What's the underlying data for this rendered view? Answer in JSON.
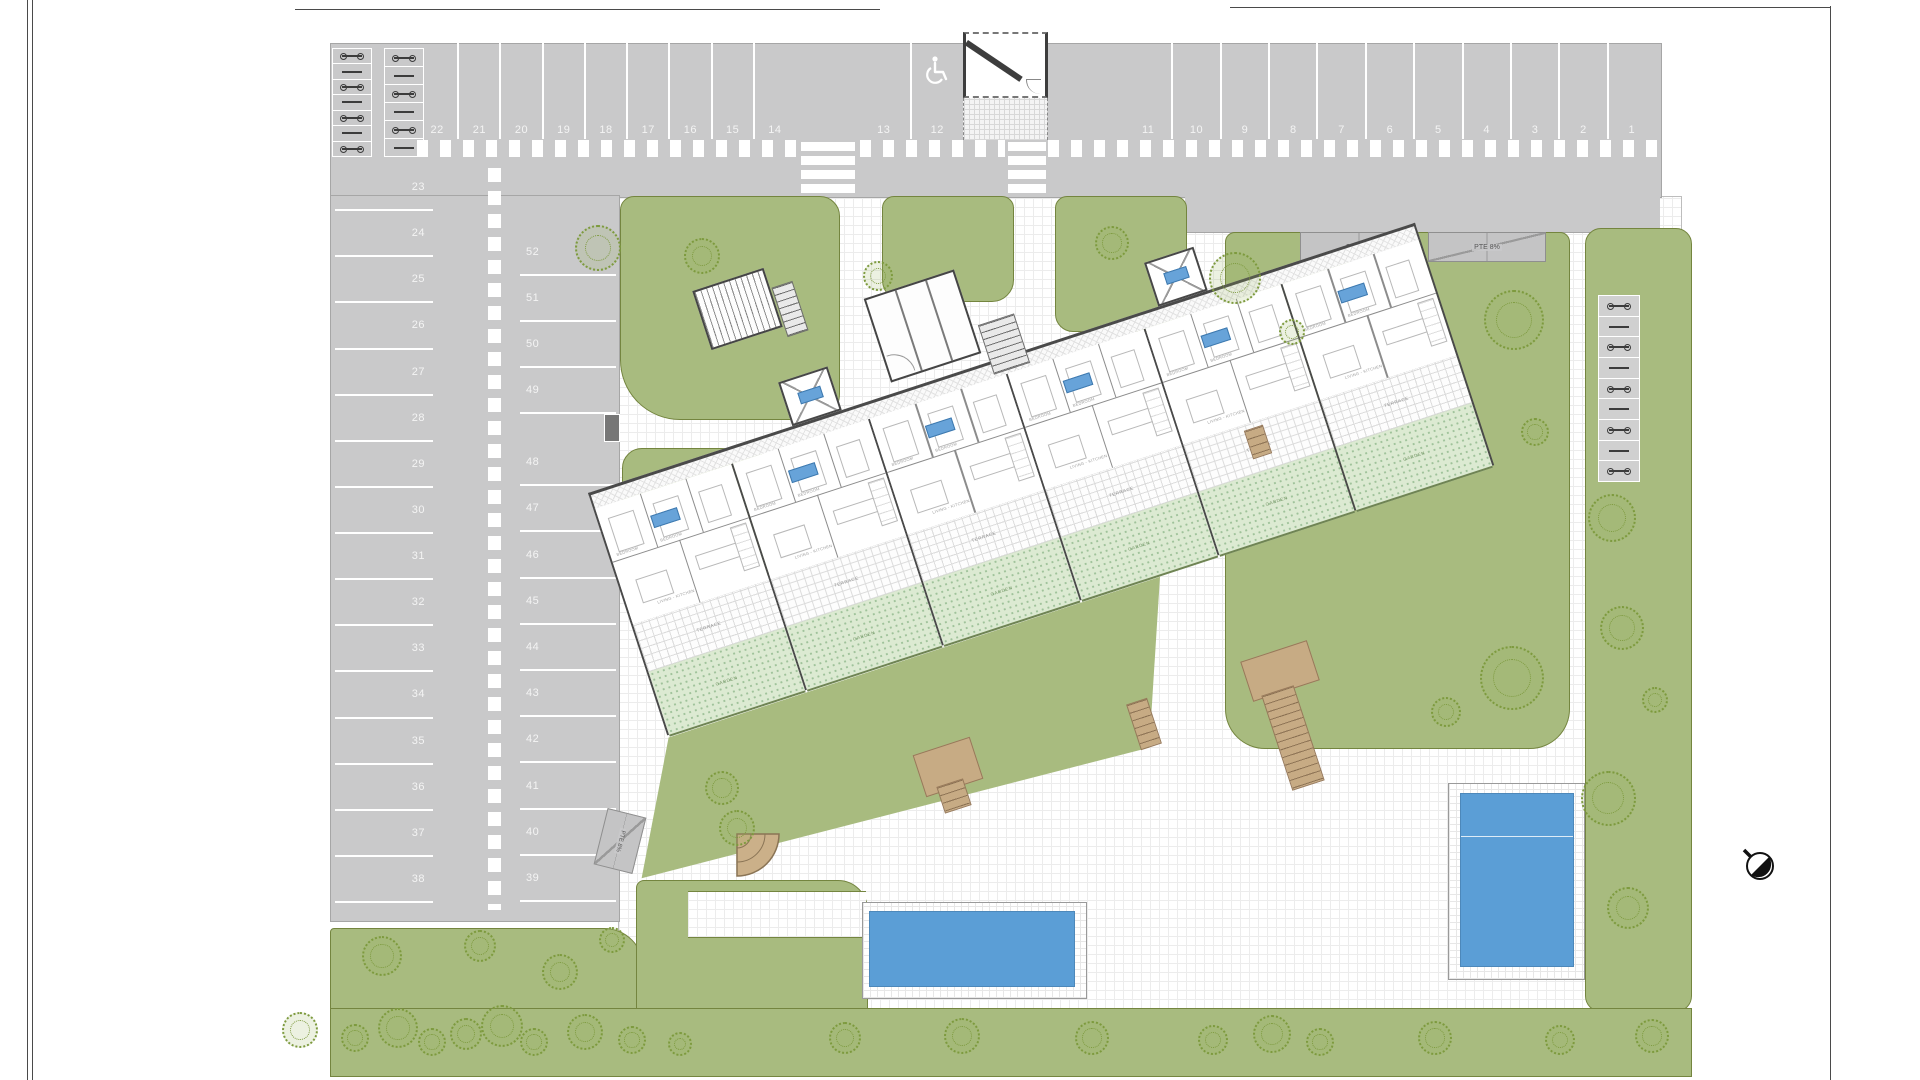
{
  "parking": {
    "top_row_left": [
      "22",
      "21",
      "20",
      "19",
      "18",
      "17",
      "16",
      "15",
      "14"
    ],
    "top_row_mid": [
      "13",
      "12"
    ],
    "accessible_space": "12",
    "top_row_right": [
      "11",
      "10",
      "9",
      "8",
      "7",
      "6",
      "5",
      "4",
      "3",
      "2",
      "1"
    ],
    "left_column": [
      "23",
      "24",
      "25",
      "26",
      "27",
      "28",
      "29",
      "30",
      "31",
      "32",
      "33",
      "34",
      "35",
      "36",
      "37",
      "38"
    ],
    "middle_column_upper": [
      "52",
      "51",
      "50",
      "49"
    ],
    "middle_column_lower": [
      "48",
      "47",
      "46",
      "45",
      "44",
      "43",
      "42",
      "41",
      "40",
      "39"
    ]
  },
  "ramps": {
    "ramp1": "PTE 8%",
    "ramp2": "PTE 8%",
    "ramp3": "PTE 8%"
  },
  "building": {
    "units": [
      {
        "badge": "",
        "room1": "BEDROOM",
        "room2": "BEDROOM",
        "room3": "LIVING - KITCHEN",
        "terrace_label": "TERRACE",
        "garden_label": "GARDEN"
      },
      {
        "badge": "",
        "room1": "BEDROOM",
        "room2": "BEDROOM",
        "room3": "LIVING - KITCHEN",
        "terrace_label": "TERRACE",
        "garden_label": "GARDEN"
      },
      {
        "badge": "",
        "room1": "BEDROOM",
        "room2": "BEDROOM",
        "room3": "LIVING - KITCHEN",
        "terrace_label": "TERRACE",
        "garden_label": "GARDEN"
      },
      {
        "badge": "",
        "room1": "BEDROOM",
        "room2": "BEDROOM",
        "room3": "LIVING - KITCHEN",
        "terrace_label": "TERRACE",
        "garden_label": "GARDEN"
      },
      {
        "badge": "",
        "room1": "BEDROOM",
        "room2": "BEDROOM",
        "room3": "LIVING - KITCHEN",
        "terrace_label": "TERRACE",
        "garden_label": "GARDEN"
      },
      {
        "badge": "",
        "room1": "BEDROOM",
        "room2": "BEDROOM",
        "room3": "LIVING - KITCHEN",
        "terrace_label": "TERRACE",
        "garden_label": "GARDEN"
      }
    ]
  },
  "colors": {
    "road": "#c9c9ca",
    "green": "#a8bb7f",
    "garden": "#dcead2",
    "pool": "#5b9ed6",
    "wood": "#c7ab84",
    "badge": "#67a3d9"
  },
  "landscape": {
    "trees": [
      [
        598,
        248,
        46
      ],
      [
        702,
        256,
        36
      ],
      [
        878,
        276,
        30
      ],
      [
        1112,
        243,
        34
      ],
      [
        1235,
        278,
        52
      ],
      [
        1514,
        320,
        60
      ],
      [
        1292,
        332,
        26
      ],
      [
        1535,
        432,
        28
      ],
      [
        1512,
        678,
        64
      ],
      [
        1446,
        712,
        30
      ],
      [
        722,
        788,
        34
      ],
      [
        737,
        828,
        36
      ],
      [
        1612,
        518,
        48
      ],
      [
        1622,
        628,
        44
      ],
      [
        1608,
        798,
        55
      ],
      [
        1628,
        908,
        42
      ],
      [
        1655,
        700,
        26
      ],
      [
        382,
        956,
        40
      ],
      [
        480,
        946,
        32
      ],
      [
        560,
        972,
        36
      ],
      [
        612,
        940,
        26
      ],
      [
        300,
        1030,
        36
      ],
      [
        355,
        1038,
        28
      ],
      [
        398,
        1028,
        40
      ],
      [
        432,
        1042,
        28
      ],
      [
        466,
        1034,
        32
      ],
      [
        502,
        1026,
        42
      ],
      [
        534,
        1042,
        28
      ],
      [
        585,
        1032,
        36
      ],
      [
        632,
        1040,
        28
      ],
      [
        680,
        1044,
        24
      ],
      [
        845,
        1038,
        32
      ],
      [
        962,
        1036,
        36
      ],
      [
        1092,
        1038,
        34
      ],
      [
        1213,
        1040,
        30
      ],
      [
        1272,
        1034,
        38
      ],
      [
        1320,
        1042,
        28
      ],
      [
        1435,
        1038,
        34
      ],
      [
        1560,
        1040,
        30
      ],
      [
        1652,
        1036,
        34
      ]
    ]
  },
  "icons": {
    "north_arrow": "north-arrow",
    "accessible": "wheelchair-icon"
  }
}
